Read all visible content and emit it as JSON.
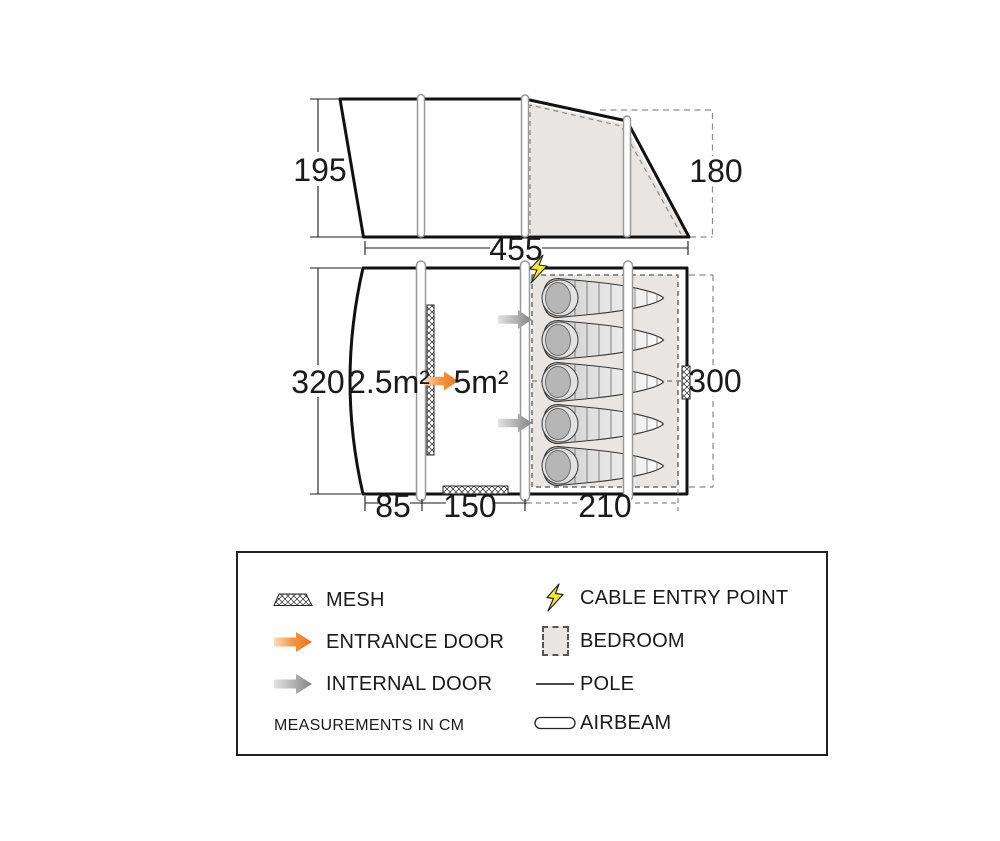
{
  "side_view": {
    "height_left": "195",
    "height_right": "180",
    "width": "455"
  },
  "floor_plan": {
    "height_left": "320",
    "height_right": "300",
    "width_porch": "85",
    "width_living": "150",
    "width_bedroom": "210",
    "porch_area": "2.5m²",
    "living_area": "5m²",
    "bed_count": 5
  },
  "legend": {
    "mesh": "MESH",
    "entrance_door": "ENTRANCE DOOR",
    "internal_door": "INTERNAL DOOR",
    "note": "MEASUREMENTS IN CM",
    "cable_entry_point": "CABLE ENTRY POINT",
    "bedroom": "BEDROOM",
    "pole": "POLE",
    "airbeam": "AIRBEAM"
  },
  "colors": {
    "entrance_door": "#ee7d23",
    "internal_door": "#8c8c8c",
    "cable_entry": "#f0e83e",
    "bedroom_fill": "#e8e5e2",
    "outline": "#111111",
    "dash_gray": "#8a8a8a"
  }
}
